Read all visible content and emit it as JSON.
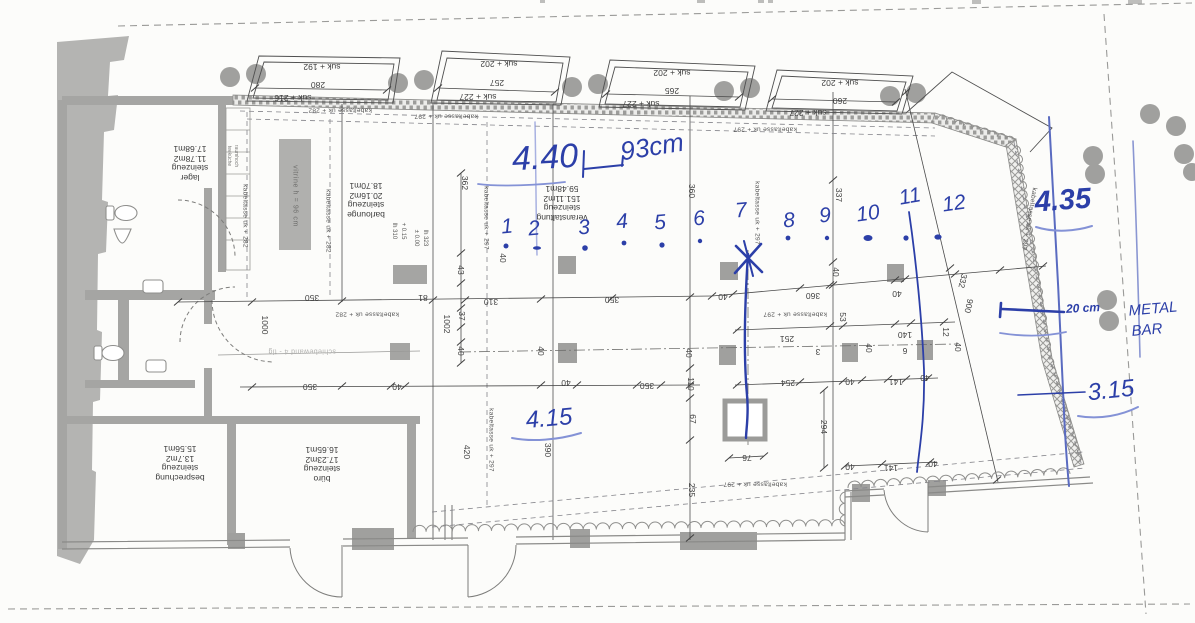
{
  "title": "Grundriss-Scan Veranstaltungsfläche mit handschriftlichen Vermassungen",
  "colors": {
    "print": "#3f3f3f",
    "wall": "#a5a5a3",
    "ink": "#2c3fa8",
    "ink_light": "#8492d6",
    "paper": "#fcfcfa"
  },
  "rooms": [
    {
      "id": "lager",
      "x": 190,
      "y": 163,
      "lines": [
        "lager",
        "steinzeug",
        "11.78m2",
        "17.68m1"
      ]
    },
    {
      "id": "barlounge",
      "x": 366,
      "y": 200,
      "lines": [
        "barlounge",
        "steinzeug",
        "20.16m2",
        "18.70m1"
      ]
    },
    {
      "id": "veranstaltung",
      "x": 562,
      "y": 203,
      "lines": [
        "veranstaltung",
        "steinzeug",
        "151.11m2",
        "59.48m1"
      ]
    },
    {
      "id": "besprechung",
      "x": 180,
      "y": 463,
      "lines": [
        "besprechung",
        "steinzeug",
        "13.7m2",
        "15.56m1"
      ]
    },
    {
      "id": "buero",
      "x": 322,
      "y": 464,
      "lines": [
        "büro",
        "steinzeug",
        "17.23m2",
        "16.65m1"
      ]
    }
  ],
  "labels": {
    "bay_dims": [
      {
        "t": "suk + 192",
        "x": 322,
        "y": 67
      },
      {
        "t": "280",
        "x": 318,
        "y": 85
      },
      {
        "t": "suk + 216",
        "x": 293,
        "y": 98
      },
      {
        "t": "suk + 202",
        "x": 499,
        "y": 64
      },
      {
        "t": "257",
        "x": 497,
        "y": 83
      },
      {
        "t": "suk + 227",
        "x": 478,
        "y": 97
      },
      {
        "t": "suk + 202",
        "x": 672,
        "y": 73
      },
      {
        "t": "265",
        "x": 672,
        "y": 91
      },
      {
        "t": "suk + 227",
        "x": 641,
        "y": 104
      },
      {
        "t": "suk + 202",
        "x": 840,
        "y": 83
      },
      {
        "t": "260",
        "x": 840,
        "y": 101
      },
      {
        "t": "suk + 227",
        "x": 808,
        "y": 113
      }
    ],
    "cable_trays": [
      {
        "t": "kabeltasse uk + 282",
        "x": 340,
        "y": 110
      },
      {
        "t": "kabeltasse uk + 297",
        "x": 446,
        "y": 116
      },
      {
        "t": "kabeltasse uk + 297",
        "x": 765,
        "y": 129
      },
      {
        "t": "kabeltasse uk + 282",
        "x": 367,
        "y": 314
      },
      {
        "t": "kabeltasse uk + 297",
        "x": 795,
        "y": 314
      },
      {
        "t": "kabeltasse uk + 297",
        "x": 755,
        "y": 484
      },
      {
        "t": "kabeltasse uk + 282",
        "x": 245,
        "y": 216,
        "r": 90
      },
      {
        "t": "kabeltasse uk + 282",
        "x": 328,
        "y": 221,
        "r": 90
      },
      {
        "t": "kabeltasse uk + 297",
        "x": 486,
        "y": 218,
        "r": 90
      },
      {
        "t": "kabeltasse uk + 297",
        "x": 757,
        "y": 213,
        "r": 90
      },
      {
        "t": "kabeltasse uk + 297",
        "x": 491,
        "y": 440,
        "r": 90
      },
      {
        "t": "kabeltasse uk + 297",
        "x": 1029,
        "y": 219,
        "r": 100
      }
    ],
    "dimensions": [
      {
        "t": "350",
        "x": 312,
        "y": 298
      },
      {
        "t": "81",
        "x": 423,
        "y": 298
      },
      {
        "t": "310",
        "x": 491,
        "y": 302
      },
      {
        "t": "350",
        "x": 612,
        "y": 300
      },
      {
        "t": "40",
        "x": 723,
        "y": 297
      },
      {
        "t": "360",
        "x": 813,
        "y": 296
      },
      {
        "t": "40",
        "x": 897,
        "y": 294
      },
      {
        "t": "350",
        "x": 310,
        "y": 387
      },
      {
        "t": "40",
        "x": 397,
        "y": 387
      },
      {
        "t": "40",
        "x": 566,
        "y": 383
      },
      {
        "t": "350",
        "x": 647,
        "y": 386
      },
      {
        "t": "254",
        "x": 788,
        "y": 383
      },
      {
        "t": "251",
        "x": 787,
        "y": 339
      },
      {
        "t": "140",
        "x": 905,
        "y": 335
      },
      {
        "t": "141",
        "x": 896,
        "y": 382
      },
      {
        "t": "40",
        "x": 850,
        "y": 382
      },
      {
        "t": "40",
        "x": 925,
        "y": 378
      },
      {
        "t": "3",
        "x": 818,
        "y": 352
      },
      {
        "t": "6",
        "x": 905,
        "y": 351
      },
      {
        "t": "76",
        "x": 747,
        "y": 458
      },
      {
        "t": "40",
        "x": 850,
        "y": 467
      },
      {
        "t": "141",
        "x": 891,
        "y": 468
      },
      {
        "t": "40",
        "x": 933,
        "y": 464
      },
      {
        "t": "362",
        "x": 465,
        "y": 183,
        "r": 90
      },
      {
        "t": "43",
        "x": 461,
        "y": 270,
        "r": 90
      },
      {
        "t": "37",
        "x": 462,
        "y": 316,
        "r": 90
      },
      {
        "t": "40",
        "x": 461,
        "y": 351,
        "r": 90
      },
      {
        "t": "1002",
        "x": 447,
        "y": 324,
        "r": 90
      },
      {
        "t": "1000",
        "x": 265,
        "y": 325,
        "r": 90
      },
      {
        "t": "40",
        "x": 541,
        "y": 351,
        "r": 90
      },
      {
        "t": "40",
        "x": 689,
        "y": 353,
        "r": 90
      },
      {
        "t": "110",
        "x": 691,
        "y": 384,
        "r": 90
      },
      {
        "t": "67",
        "x": 693,
        "y": 419,
        "r": 90
      },
      {
        "t": "235",
        "x": 692,
        "y": 490,
        "r": 90
      },
      {
        "t": "420",
        "x": 467,
        "y": 452,
        "r": 90
      },
      {
        "t": "390",
        "x": 548,
        "y": 450,
        "r": 90
      },
      {
        "t": "360",
        "x": 692,
        "y": 191,
        "r": 90
      },
      {
        "t": "337",
        "x": 839,
        "y": 195,
        "r": 90
      },
      {
        "t": "40",
        "x": 836,
        "y": 272,
        "r": 90
      },
      {
        "t": "40",
        "x": 503,
        "y": 258,
        "r": 90
      },
      {
        "t": "294",
        "x": 824,
        "y": 427,
        "r": 90
      },
      {
        "t": "12",
        "x": 946,
        "y": 332,
        "r": 90
      },
      {
        "t": "40",
        "x": 958,
        "y": 347,
        "r": 90
      },
      {
        "t": "40",
        "x": 869,
        "y": 348,
        "r": 90
      },
      {
        "t": "53",
        "x": 843,
        "y": 317,
        "r": 90
      },
      {
        "t": "332",
        "x": 963,
        "y": 281,
        "r": 103
      },
      {
        "t": "900",
        "x": 969,
        "y": 306,
        "r": 103
      }
    ],
    "texts": [
      {
        "t": "vitrine h = 96 cm",
        "x": 295,
        "y": 196,
        "r": 90,
        "c": "tiny"
      },
      {
        "t": "schiebewand 4 - tlg",
        "x": 302,
        "y": 351,
        "r": 180,
        "c": "faint"
      },
      {
        "t": "teeküche",
        "x": 229,
        "y": 156,
        "r": 90,
        "c": "micro"
      },
      {
        "t": "raumhoch",
        "x": 236,
        "y": 156,
        "r": 90,
        "c": "micro"
      },
      {
        "t": "lh 310",
        "x": 394,
        "y": 231,
        "r": 90,
        "c": "micro2"
      },
      {
        "t": "+ 0.15",
        "x": 403,
        "y": 231,
        "r": 90,
        "c": "micro2"
      },
      {
        "t": "± 0.00",
        "x": 416,
        "y": 238,
        "r": 90,
        "c": "micro2"
      },
      {
        "t": "lh 323",
        "x": 425,
        "y": 238,
        "r": 90,
        "c": "micro2"
      }
    ],
    "annotations": [
      {
        "t": "4.40",
        "x": 545,
        "y": 158,
        "r": -3,
        "s": 34
      },
      {
        "t": "93cm",
        "x": 652,
        "y": 147,
        "r": -9,
        "s": 26
      },
      {
        "t": "1",
        "x": 507,
        "y": 227,
        "r": -5,
        "s": 21
      },
      {
        "t": "2",
        "x": 534,
        "y": 229,
        "r": -5,
        "s": 21
      },
      {
        "t": "3",
        "x": 584,
        "y": 228,
        "r": -5,
        "s": 21
      },
      {
        "t": "4",
        "x": 622,
        "y": 222,
        "r": -5,
        "s": 21
      },
      {
        "t": "5",
        "x": 660,
        "y": 223,
        "r": -5,
        "s": 21
      },
      {
        "t": "6",
        "x": 699,
        "y": 219,
        "r": -5,
        "s": 21
      },
      {
        "t": "7",
        "x": 741,
        "y": 211,
        "r": -5,
        "s": 21
      },
      {
        "t": "8",
        "x": 789,
        "y": 221,
        "r": -5,
        "s": 21
      },
      {
        "t": "9",
        "x": 825,
        "y": 216,
        "r": -5,
        "s": 21
      },
      {
        "t": "10",
        "x": 868,
        "y": 214,
        "r": -8,
        "s": 21
      },
      {
        "t": "11",
        "x": 910,
        "y": 197,
        "r": -10,
        "s": 21
      },
      {
        "t": "12",
        "x": 954,
        "y": 204,
        "r": -8,
        "s": 21
      },
      {
        "t": "4.35",
        "x": 1063,
        "y": 201,
        "r": -4,
        "s": 29,
        "w": "bold"
      },
      {
        "t": "20 cm",
        "x": 1083,
        "y": 308,
        "r": -3,
        "s": 12,
        "w": "bold"
      },
      {
        "t": "METAL",
        "x": 1153,
        "y": 309,
        "r": -5,
        "s": 15
      },
      {
        "t": "BAR",
        "x": 1147,
        "y": 330,
        "r": -5,
        "s": 15
      },
      {
        "t": "3.15",
        "x": 1111,
        "y": 391,
        "r": -6,
        "s": 24
      },
      {
        "t": "4.15",
        "x": 549,
        "y": 419,
        "r": -5,
        "s": 24
      }
    ]
  }
}
